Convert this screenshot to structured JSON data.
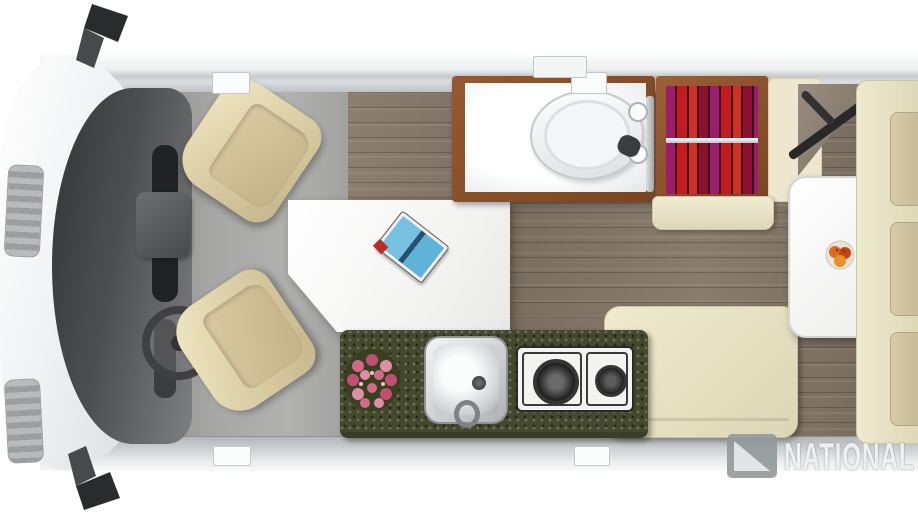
{
  "diagram_type": "rv-camper-van-floorplan-top-view",
  "watermark": {
    "text": "NATIONAL",
    "logo": "flag-triangle-logo"
  },
  "colors": {
    "background": "#ffffff",
    "van_wall": "#c7cbcd",
    "cab_floor": "#a8a8a6",
    "wood_floor": "#84766a",
    "bathroom_frame": "#8a5130",
    "wardrobe_frame": "#8a4f2c",
    "clothes_red": "#c41a1f",
    "clothes_magenta": "#9c1d6e",
    "counter_granite": "#44482f",
    "bench_cream": "#ebe6c9",
    "cushion_tan": "#cdc1a0",
    "seat_beige": "#ddd0a8",
    "table_white": "#fbfbfb",
    "fruit_orange": "#e06a1c",
    "flowers_pink": "#d2688a",
    "book_blue": "#68b5dc"
  },
  "floorplan": {
    "sections": [
      {
        "name": "cab",
        "items": [
          "hood",
          "windshield",
          "grille-vents",
          "side-mirrors",
          "steering-wheel",
          "engine-console",
          "passenger-swivel-seat",
          "driver-swivel-seat"
        ]
      },
      {
        "name": "dinette",
        "items": [
          "pedestal-table",
          "open-book"
        ]
      },
      {
        "name": "bathroom",
        "items": [
          "wet-bath-floor",
          "toilet",
          "shower-rod",
          "shower-knobs",
          "sprayer"
        ]
      },
      {
        "name": "wardrobe",
        "items": [
          "hanging-clothes",
          "clothes-rail"
        ]
      },
      {
        "name": "kitchen",
        "items": [
          "granite-counter",
          "flower-bouquet",
          "sink",
          "faucet",
          "two-burner-stove"
        ]
      },
      {
        "name": "rear-lounge",
        "items": [
          "bench-seat-back",
          "lounge-bench",
          "rear-table",
          "fruit-bowl",
          "rear-sofa",
          "sofa-cushions",
          "tv-swivel-arm",
          "corner-cabinet"
        ]
      }
    ]
  }
}
